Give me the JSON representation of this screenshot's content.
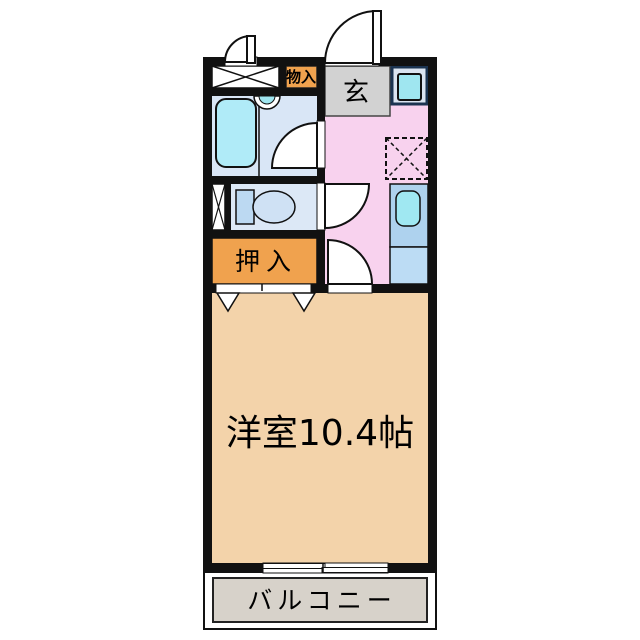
{
  "plan": {
    "labels": {
      "storage_small": "物入",
      "entrance": "玄",
      "closet": "押入",
      "main_room": "洋室10.4帖",
      "balcony": "バルコニー"
    },
    "colors": {
      "wall": "#111111",
      "hall_pink": "#f8d2ee",
      "genkan_gray": "#d2d2d2",
      "bath_blue": "#d9e6f6",
      "tub_cyan": "#b0ebf8",
      "toilet_blue": "#dce8f6",
      "fixture_blue": "#bcd9f2",
      "bowl_blue": "#cfe1f4",
      "kitchen_blue": "#aed2ee",
      "kitchen_lower_blue": "#bcdcf4",
      "sink_cyan": "#a0e8f2",
      "appliance_cyan": "#9fe6f0",
      "storage_orange": "#f0a24e",
      "room_tan": "#f3d3aa",
      "balcony_gray": "#d7d2ca"
    }
  }
}
